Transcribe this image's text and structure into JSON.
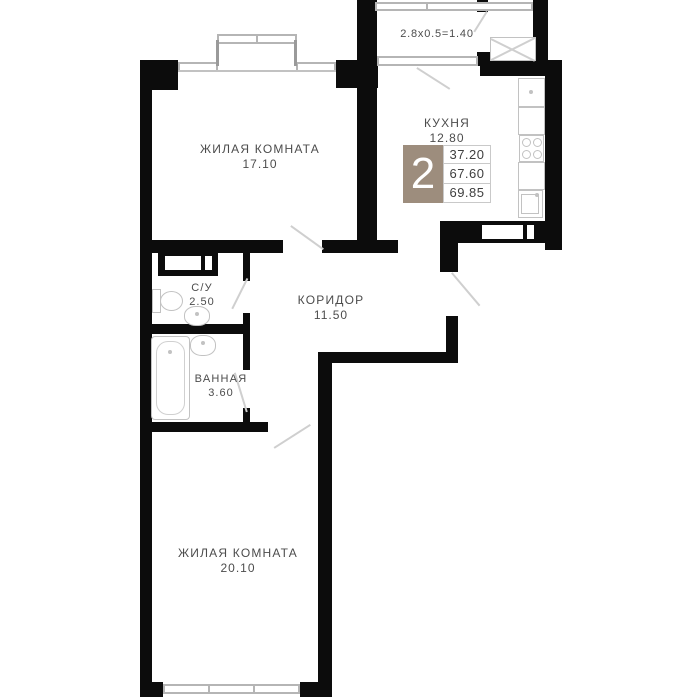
{
  "plan": {
    "title": "apartment-floor-plan",
    "rooms": [
      {
        "id": "living-1",
        "name": "ЖИЛАЯ КОМНАТА",
        "area": "17.10"
      },
      {
        "id": "kitchen",
        "name": "КУХНЯ",
        "area": "12.80"
      },
      {
        "id": "wc",
        "name": "С/У",
        "area": "2.50"
      },
      {
        "id": "bathroom",
        "name": "ВАННАЯ",
        "area": "3.60"
      },
      {
        "id": "corridor",
        "name": "КОРИДОР",
        "area": "11.50"
      },
      {
        "id": "living-2",
        "name": "ЖИЛАЯ КОМНАТА",
        "area": "20.10"
      }
    ],
    "balcony_label": "2.8x0.5=1.40",
    "badge": {
      "rooms_count": "2",
      "areas": [
        "37.20",
        "67.60",
        "69.85"
      ],
      "accent_color": "#9d8d7d"
    },
    "colors": {
      "wall": "#0c0c0c",
      "fixture_outline": "#c2c2c2",
      "label_text": "#4c4c4c"
    }
  }
}
